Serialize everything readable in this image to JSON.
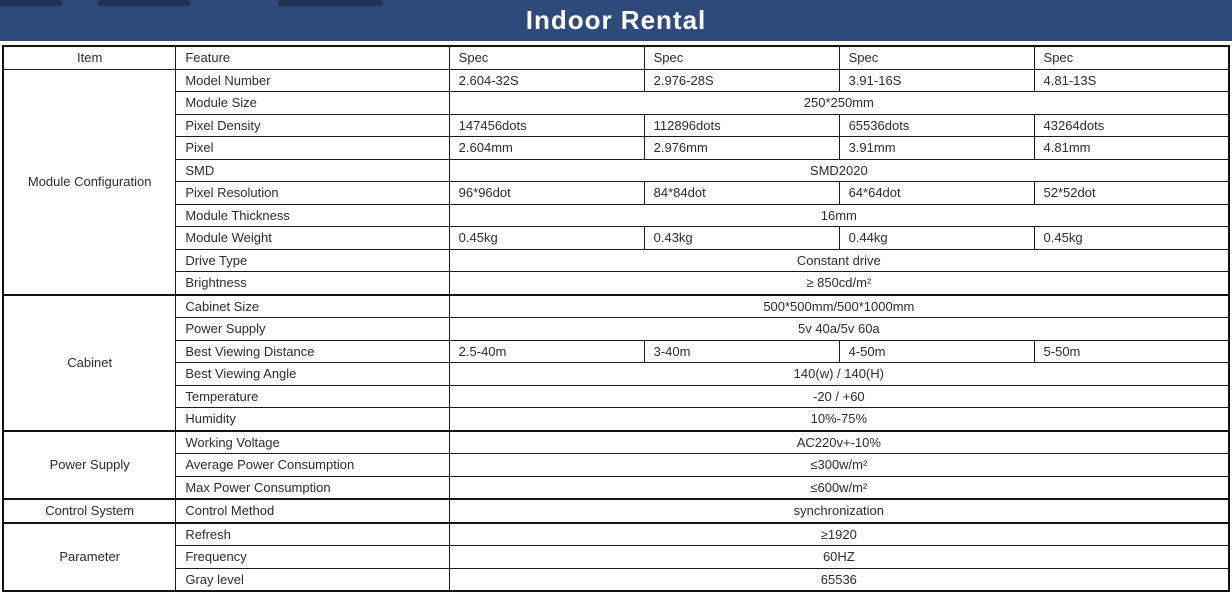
{
  "title": "Indoor Rental",
  "colors": {
    "banner": "#2e4a7a",
    "border": "#1b1b1b",
    "text": "#2d2d2d",
    "banner_text": "#ffffff"
  },
  "table": {
    "header": {
      "columns": [
        "Item",
        "Feature",
        "Spec",
        "Spec",
        "Spec",
        "Spec"
      ]
    },
    "sections": [
      {
        "item": "Module Configuration",
        "rows": [
          {
            "feature": "Model Number",
            "specs": [
              "2.604-32S",
              "2.976-28S",
              "3.91-16S",
              "4.81-13S"
            ]
          },
          {
            "feature": "Module Size",
            "span": "250*250mm"
          },
          {
            "feature": "Pixel Density",
            "specs": [
              "147456dots",
              "112896dots",
              "65536dots",
              "43264dots"
            ]
          },
          {
            "feature": "Pixel",
            "specs": [
              "2.604mm",
              "2.976mm",
              "3.91mm",
              "4.81mm"
            ]
          },
          {
            "feature": "SMD",
            "span": "SMD2020"
          },
          {
            "feature": "Pixel Resolution",
            "specs": [
              "96*96dot",
              "84*84dot",
              "64*64dot",
              "52*52dot"
            ]
          },
          {
            "feature": "Module Thickness",
            "span": "16mm"
          },
          {
            "feature": "Module Weight",
            "specs": [
              "0.45kg",
              "0.43kg",
              "0.44kg",
              "0.45kg"
            ]
          },
          {
            "feature": "Drive Type",
            "span": "Constant drive"
          },
          {
            "feature": "Brightness",
            "span": "≥ 850cd/m²"
          }
        ]
      },
      {
        "item": "Cabinet",
        "rows": [
          {
            "feature": "Cabinet Size",
            "span": "500*500mm/500*1000mm"
          },
          {
            "feature": "Power Supply",
            "span": "5v 40a/5v 60a"
          },
          {
            "feature": "Best Viewing Distance",
            "specs": [
              "2.5-40m",
              "3-40m",
              "4-50m",
              "5-50m"
            ]
          },
          {
            "feature": "Best Viewing Angle",
            "span": "140(w) / 140(H)"
          },
          {
            "feature": "Temperature",
            "span": "-20 / +60"
          },
          {
            "feature": "Humidity",
            "span": "10%-75%"
          }
        ]
      },
      {
        "item": "Power Supply",
        "rows": [
          {
            "feature": "Working Voltage",
            "span": "AC220v+-10%"
          },
          {
            "feature": "Average Power Consumption",
            "span": "≤300w/m²"
          },
          {
            "feature": "Max Power Consumption",
            "span": "≤600w/m²"
          }
        ]
      },
      {
        "item": "Control System",
        "rows": [
          {
            "feature": "Control Method",
            "span": "synchronization"
          }
        ]
      },
      {
        "item": "Parameter",
        "rows": [
          {
            "feature": "Refresh",
            "span": "≥1920"
          },
          {
            "feature": "Frequency",
            "span": "60HZ"
          },
          {
            "feature": "Gray level",
            "span": "65536"
          }
        ]
      }
    ]
  }
}
